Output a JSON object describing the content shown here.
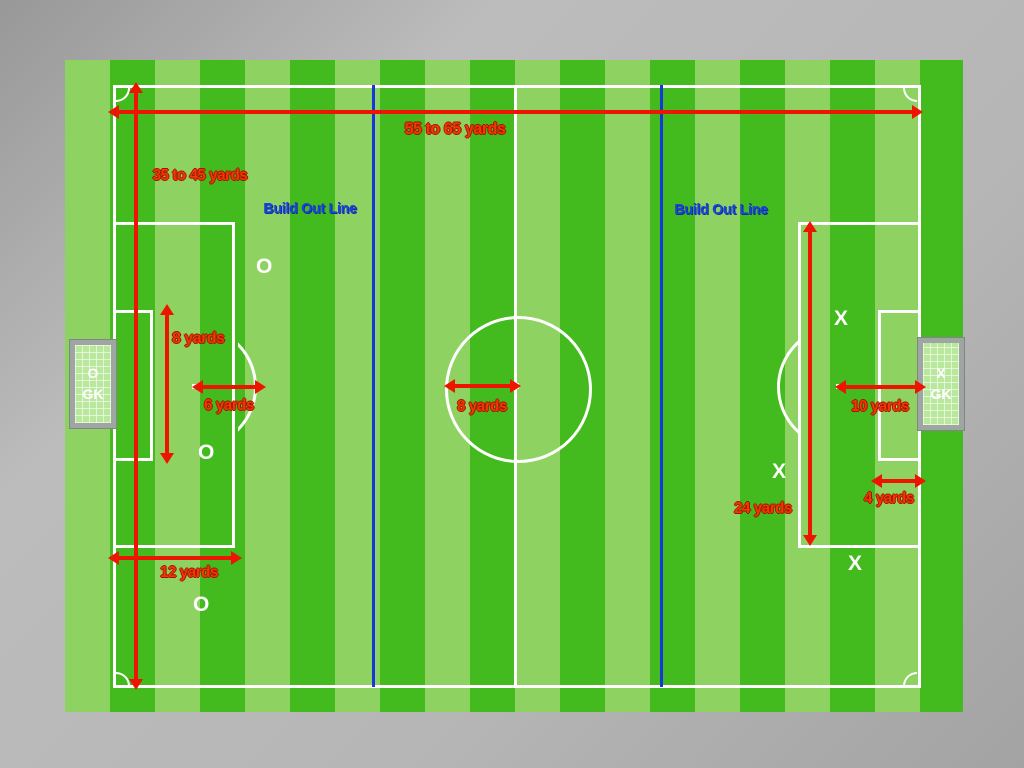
{
  "diagram": {
    "measurements": {
      "field_width": "55 to 65 yards",
      "field_length": "35 to 45 yards",
      "goal_area_height": "8 yards",
      "penalty_spot_left": "6 yards",
      "center_circle_radius": "8 yards",
      "penalty_area_width": "12 yards",
      "penalty_area_height": "24 yards",
      "penalty_spot_right": "10 yards",
      "goal_area_depth": "4 yards"
    },
    "build_out_line_label": "Build Out Line",
    "players": {
      "offense": "O",
      "defense": "X",
      "goalkeeper": "GK"
    },
    "colors": {
      "stripe_dark": "#43ba1d",
      "stripe_light": "#8ed361",
      "line_white": "#ffffff",
      "arrow_red": "#ee1500",
      "label_red": "#ea3c00",
      "build_out_blue": "#1538db",
      "background_gray": "#b3b3b3",
      "goal_frame_gray": "#9fa5a2",
      "goal_net_green": "#b9e79b"
    }
  }
}
